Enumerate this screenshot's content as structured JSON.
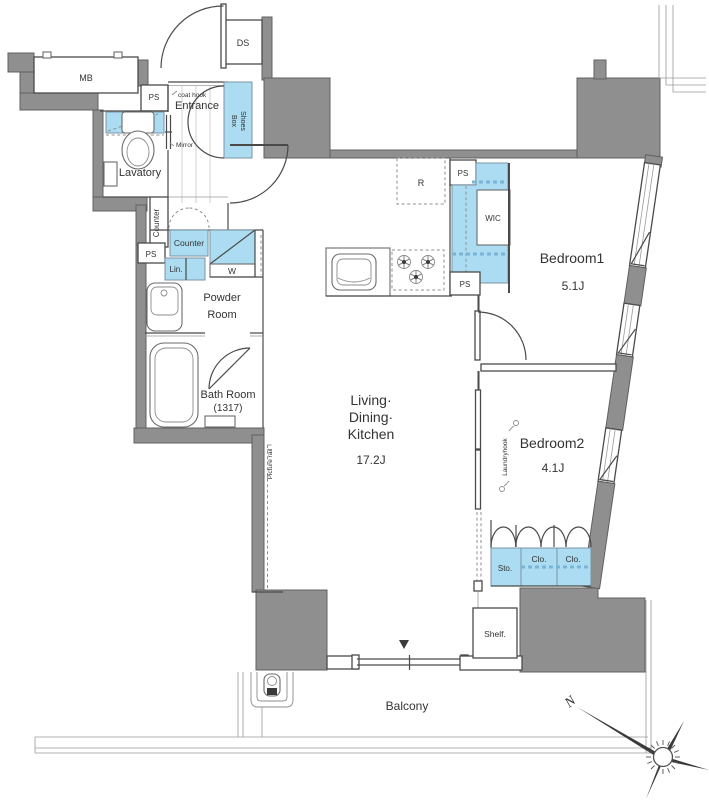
{
  "rooms": {
    "entrance": "Entrance",
    "lavatory": "Lavatory",
    "powder_line1": "Powder",
    "powder_line2": "Room",
    "bath": "Bath Room",
    "bath_size": "(1317)",
    "ldk_line1": "Living·",
    "ldk_line2": "Dining·",
    "ldk_line3": "Kitchen",
    "ldk_size": "17.2J",
    "bedroom1": "Bedroom1",
    "bedroom1_size": "5.1J",
    "bedroom2": "Bedroom2",
    "bedroom2_size": "4.1J",
    "balcony": "Balcony"
  },
  "storage": {
    "shoes_line1": "Shoes",
    "shoes_line2": "Box",
    "wic": "WIC",
    "closet": "Clo.",
    "storage": "Sto.",
    "linen": "Lin.",
    "shelf": "Shelf.",
    "washer": "W"
  },
  "labels": {
    "mb": "MB",
    "ds": "DS",
    "ps": "PS",
    "refrigerator": "R",
    "coat_hook": "coat hook",
    "mirror": "Mirror",
    "counter": "Counter",
    "counter_hall": "Counter",
    "laundry_hook": "Laundryhook",
    "picture_rail": "Picture rail"
  },
  "compass": {
    "north": "N"
  },
  "colors": {
    "wall": "#8f8f8f",
    "wall_border": "#606060",
    "blue": "#abdcf1",
    "blue_border": "#7d95a3",
    "blue_dash": "#7ab5d5",
    "line": "#4a4a4a",
    "text": "#333333"
  }
}
